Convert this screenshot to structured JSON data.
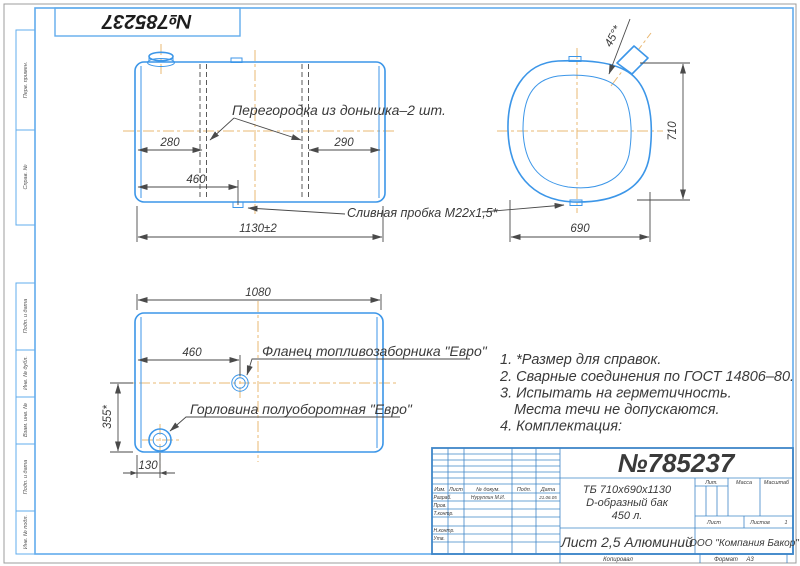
{
  "page": {
    "stamp_number": "№785237"
  },
  "margin": {
    "top_labels": [
      "Перв. примен.",
      "Справ. №"
    ],
    "bottom_labels": [
      "Подп. и дата",
      "Инв. № дубл.",
      "Взам. инв. №",
      "Подп. и дата",
      "Инв. № подл."
    ]
  },
  "side_view": {
    "baffle_label": "Перегородка из донышка–2 шт.",
    "drain_label": "Сливная пробка М22х1,5*",
    "dim_280": "280",
    "dim_290": "290",
    "dim_460": "460",
    "dim_length": "1130±2"
  },
  "section_view": {
    "dim_angle": "45°*",
    "dim_height": "710",
    "dim_width": "690"
  },
  "top_view": {
    "flange_label": "Фланец топливозаборника \"Евро\"",
    "neck_label": "Горловина полуоборотная \"Евро\"",
    "dim_length": "1080",
    "dim_460": "460",
    "dim_355": "355*",
    "dim_130": "130"
  },
  "notes": {
    "line1": "1. *Размер для справок.",
    "line2": "2. Сварные соединения по ГОСТ 14806–80.",
    "line3": "3. Испытать на герметичность.",
    "line4": "Места течи не допускаются.",
    "line5": "4. Комплектация:"
  },
  "title_block": {
    "doc_number": "№785237",
    "desc_line1": "ТБ 710х690х1130",
    "desc_line2": "D-образный бак",
    "desc_line3": "450 л.",
    "material": "Лист 2,5 Алюминий",
    "company": "ООО \"Компания Бакор\"",
    "col_izm": "Изм.",
    "col_list": "Лист",
    "col_dokum": "№ докум.",
    "col_podp": "Подп.",
    "col_data": "Дата",
    "row_razrab": "Разраб.",
    "razrab_name": "Нуруллин М.И.",
    "razrab_date": "21.06.05",
    "row_prov": "Пров.",
    "row_tkontr": "Т.контр.",
    "row_nkontr": "Н.контр.",
    "row_utv": "Утв.",
    "lit": "Лит.",
    "massa": "Масса",
    "masshtab": "Масштаб",
    "list": "Лист",
    "listov": "Листов",
    "listov_value": "1",
    "kopiroval": "Копировал",
    "format": "Формат",
    "format_value": "А3"
  }
}
